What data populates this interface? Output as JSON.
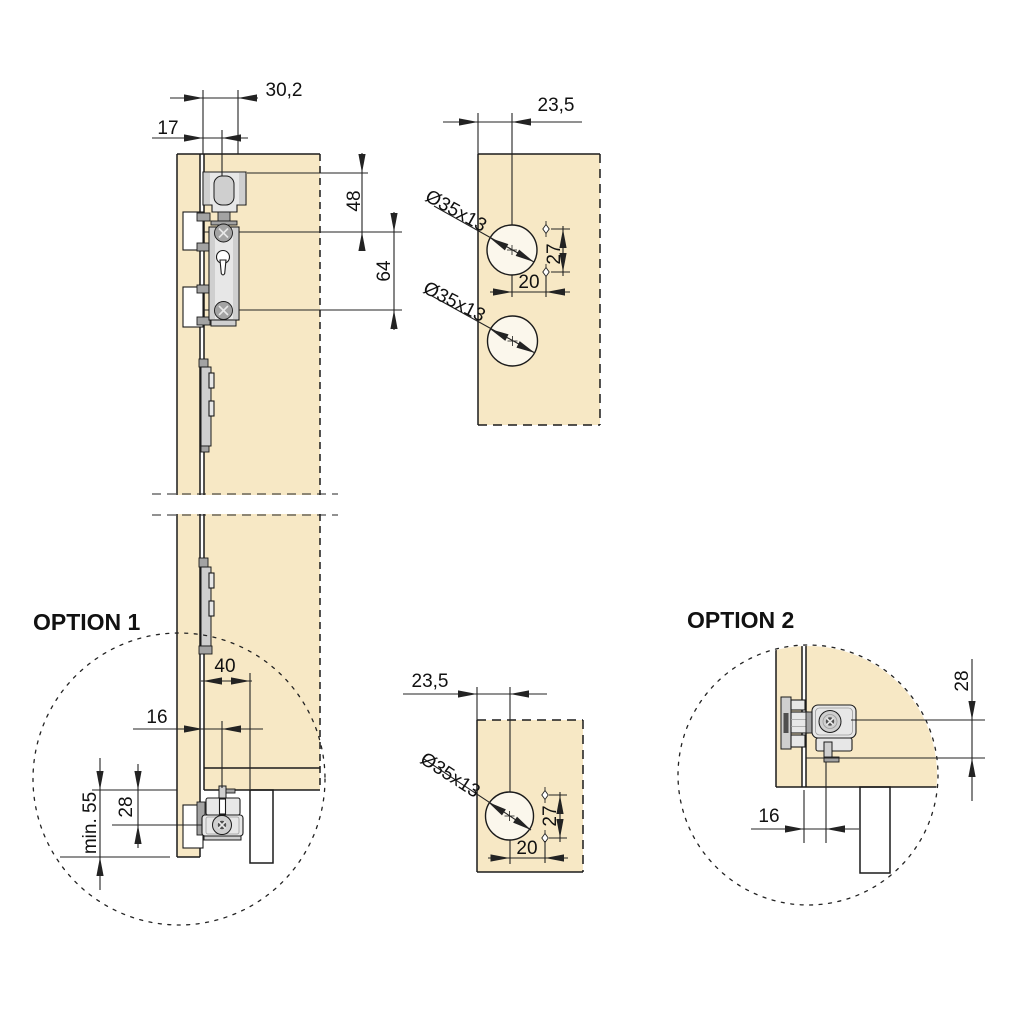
{
  "colors": {
    "panel": "#F7E8C5",
    "hole": "#FBF7EC",
    "line": "#1b1b1b",
    "dim": "#232323",
    "hw_light": "#E7E7E7",
    "hw_mid": "#CFCFCF",
    "hw_dark": "#A3A3A3",
    "hw_darkest": "#4f4f4f"
  },
  "main_view": {
    "dim_top_offset": "30,2",
    "dim_door_thickness": "17",
    "dim_top_to_plate": "48",
    "dim_screw_spacing": "64"
  },
  "template_top": {
    "dim_edge_offset": "23,5",
    "hole_label_1": "Ø35x13",
    "hole_label_2": "Ø35x13",
    "dim_screw_vertical": "27",
    "dim_screw_horizontal": "20"
  },
  "template_bottom": {
    "dim_edge_offset": "23,5",
    "hole_label": "Ø35x13",
    "dim_screw_vertical": "27",
    "dim_screw_horizontal": "20"
  },
  "option1": {
    "label": "OPTION 1",
    "dim_track_offset": "40",
    "dim_guide_inset": "16",
    "dim_min_height": "min. 55",
    "dim_screw_height": "28"
  },
  "option2": {
    "label": "OPTION 2",
    "dim_screw_height": "28",
    "dim_guide_inset": "16"
  }
}
